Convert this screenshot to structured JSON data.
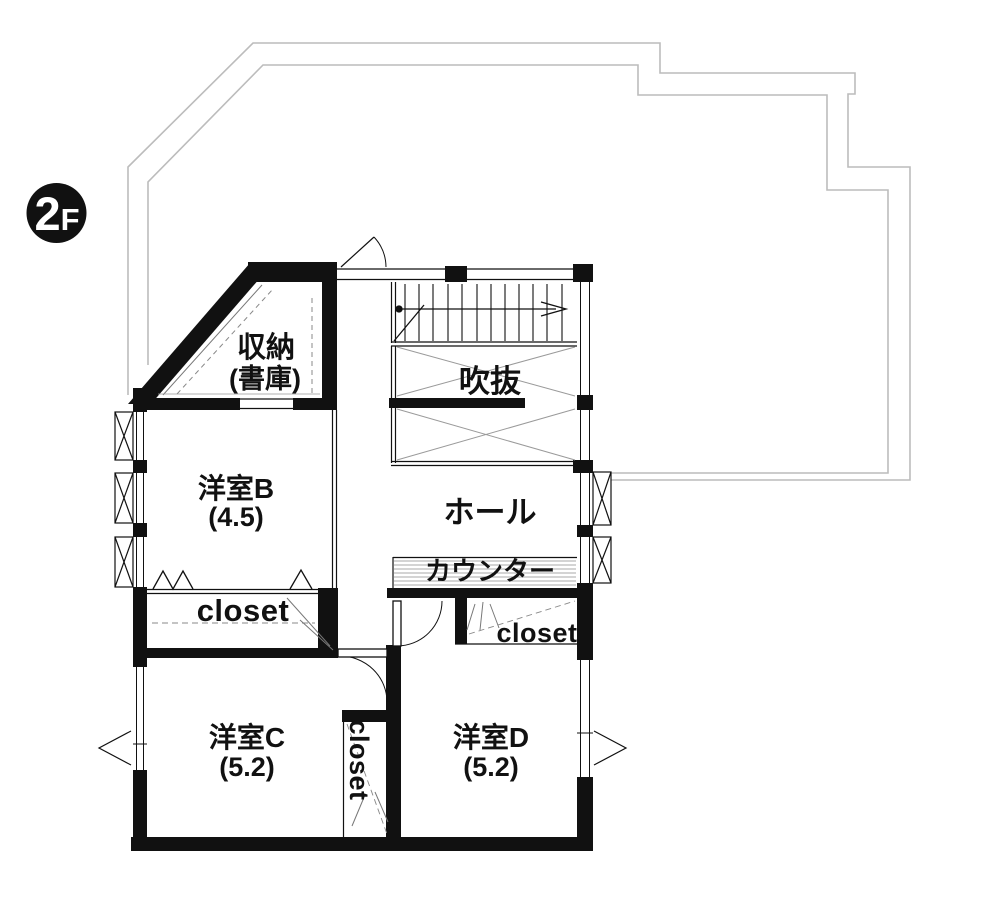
{
  "floor_badge": {
    "number": "2",
    "suffix": "F"
  },
  "rooms": {
    "storage": {
      "name": "収納",
      "sub": "(書庫)"
    },
    "void": {
      "name": "吹抜"
    },
    "room_b": {
      "name": "洋室B",
      "area": "(4.5)"
    },
    "hall": {
      "name": "ホール"
    },
    "counter_label": "カウンター",
    "closet_b_label": "closet",
    "closet_c_label": "closet",
    "closet_d_label": "closet",
    "room_c": {
      "name": "洋室C",
      "area": "(5.2)"
    },
    "room_d": {
      "name": "洋室D",
      "area": "(5.2)"
    }
  },
  "colors": {
    "wall": "#111111",
    "balcony_outline": "#bcbcbc",
    "hatch": "#999999",
    "dashed": "#888888",
    "background": "#ffffff"
  }
}
